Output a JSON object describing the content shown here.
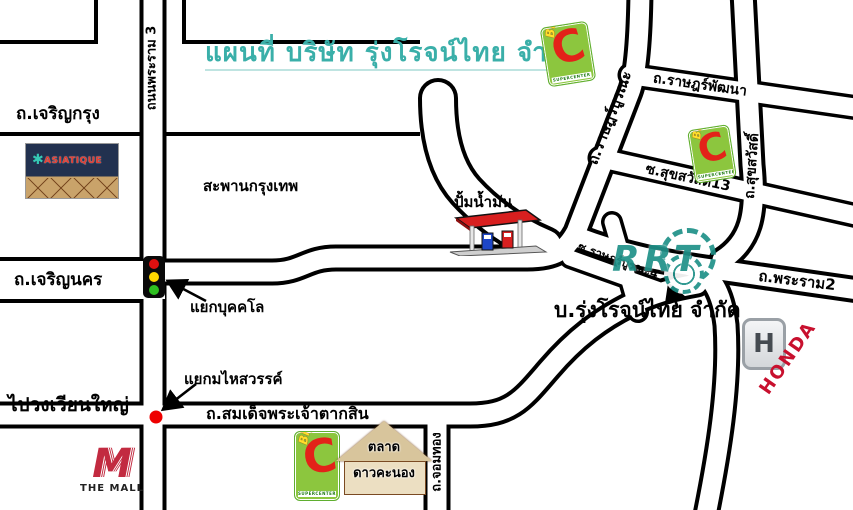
{
  "title": {
    "text": "แผนที่ บริษัท รุ่งโรจน์ไทย จำกัด"
  },
  "roads": {
    "rama3": "ถนนพระราม 3",
    "charoen_krung": "ถ.เจริญกรุง",
    "charoen_nakhon": "ถ.เจริญนคร",
    "taksin": "ถ.สมเด็จพระเจ้าตากสิน",
    "chom_thong": "ถ.จอมทอง",
    "rat_burana": "ถ.ราษฎร์บูรณะ",
    "rat_phatthana": "ถ.ราษฎร์พัฒนา",
    "soi_suk_sawat_13": "ซ.สุขสวัสดิ์13",
    "suk_sawat": "ถ.สุขสวัสดิ์",
    "soi_rat_burana_4": "ซ.ราษฎร์บูรณะ4",
    "rama2": "ถ.พระราม2"
  },
  "junctions": {
    "bukkhalo": "แยกบุคคโล",
    "mahaisawan": "แยกมไหสวรรค์"
  },
  "places": {
    "bridge": "สะพานกรุงเทพ",
    "wongwian_yai": "ไปวงเวียนใหญ่",
    "gas_station": "ปั้มน้ำมัน",
    "company": "บ.รุ่งโรจน์ไทย จำกัด",
    "market_line1": "ตลาด",
    "market_line2": "ดาวคะนอง"
  },
  "logos": {
    "asiatique": "ASIATIQUE",
    "the_mall_m": "M",
    "the_mall": "THE MALL",
    "honda_h": "H",
    "honda": "HONDA",
    "rrt": "RRT",
    "bigc_big": "Big",
    "bigc_c": "C",
    "bigc_sub": "SUPERCENTER"
  },
  "colors": {
    "title_teal": "#3aafa9",
    "road_line": "#000000",
    "traffic_red": "#e01010",
    "traffic_yellow": "#ffd800",
    "traffic_green": "#2fc021",
    "junction_dot_red": "#ee0000",
    "bigc_green": "#8CC63E",
    "bigc_red": "#E32219",
    "honda_red": "#C8102E",
    "rrt_teal": "#1f9188",
    "mall_red": "#c22a40"
  }
}
